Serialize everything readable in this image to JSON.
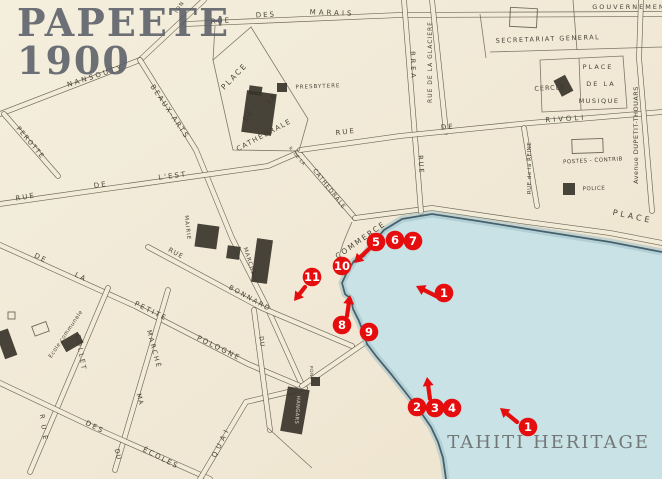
{
  "header": {
    "title_line1": "PAPEETE",
    "title_line2": "1900"
  },
  "watermark": "TAHITI HERITAGE",
  "colors": {
    "paper": "#f2ebd8",
    "water": "#c9e2e6",
    "ink": "#57503f",
    "label_ink": "#3b352b",
    "marker_red": "#e50d0d",
    "title_grey": "#5a5f68",
    "watermark_grey": "#6e7272"
  },
  "map": {
    "labels": [
      {
        "t": "RUE",
        "x": 221,
        "y": 23,
        "r": -4,
        "s": 7,
        "sp": 2
      },
      {
        "t": "DES",
        "x": 266,
        "y": 17,
        "r": -3,
        "s": 7,
        "sp": 2
      },
      {
        "t": "MARAIS",
        "x": 332,
        "y": 15,
        "r": 2,
        "s": 7,
        "sp": 3
      },
      {
        "t": "ION",
        "x": 181,
        "y": 8,
        "r": -58,
        "s": 5.5,
        "sp": 1
      },
      {
        "t": "GOUVERNEMENT",
        "x": 632,
        "y": 9,
        "r": 0,
        "s": 6.5,
        "sp": 2
      },
      {
        "t": "SECRETARIAT GENERAL",
        "x": 548,
        "y": 41,
        "r": -2,
        "s": 6.5,
        "sp": 1.5
      },
      {
        "t": "RUE DE LA GLACIERE",
        "x": 432,
        "y": 62,
        "r": -90,
        "s": 6,
        "sp": 1
      },
      {
        "t": "PLACE",
        "x": 598,
        "y": 69,
        "r": 0,
        "s": 6.5,
        "sp": 2
      },
      {
        "t": "DE LA",
        "x": 601,
        "y": 86,
        "r": 0,
        "s": 6.5,
        "sp": 2
      },
      {
        "t": "MUSIQUE",
        "x": 599,
        "y": 103,
        "r": 0,
        "s": 6.5,
        "sp": 1.5
      },
      {
        "t": "CERCLE",
        "x": 550,
        "y": 90,
        "r": -3,
        "s": 6.5,
        "sp": 1
      },
      {
        "t": "RUE",
        "x": 346,
        "y": 134,
        "r": -7,
        "s": 7,
        "sp": 2
      },
      {
        "t": "DE",
        "x": 448,
        "y": 129,
        "r": -5,
        "s": 7,
        "sp": 2
      },
      {
        "t": "RIVOLI",
        "x": 566,
        "y": 121,
        "r": -4,
        "s": 7,
        "sp": 3
      },
      {
        "t": "RUE de la REINE",
        "x": 531,
        "y": 168,
        "r": -90,
        "s": 5.5,
        "sp": 0.5
      },
      {
        "t": "POSTES - CONTRIB",
        "x": 593,
        "y": 162,
        "r": -3,
        "s": 5.5,
        "sp": 0.5
      },
      {
        "t": "POLICE",
        "x": 594,
        "y": 190,
        "r": -2,
        "s": 5.5,
        "sp": 0.5
      },
      {
        "t": "Avenue DUPETIT-THOUARS",
        "x": 638,
        "y": 135,
        "r": -90,
        "s": 6.5,
        "sp": 0.5
      },
      {
        "t": "PLACE",
        "x": 632,
        "y": 219,
        "r": 12,
        "s": 8,
        "sp": 3
      },
      {
        "t": "PLACE",
        "x": 236,
        "y": 78,
        "r": -46,
        "s": 7.5,
        "sp": 2
      },
      {
        "t": "DE",
        "x": 250,
        "y": 117,
        "r": -50,
        "s": 7,
        "sp": 1
      },
      {
        "t": "LA",
        "x": 273,
        "y": 100,
        "r": -50,
        "s": 7,
        "sp": 1
      },
      {
        "t": "CATHEDRALE",
        "x": 265,
        "y": 137,
        "r": -28,
        "s": 7,
        "sp": 1.5
      },
      {
        "t": "R. DE LA",
        "x": 296,
        "y": 157,
        "r": 50,
        "s": 4.5,
        "sp": 0.5
      },
      {
        "t": "CATHEDRALE",
        "x": 328,
        "y": 190,
        "r": 52,
        "s": 6,
        "sp": 1
      },
      {
        "t": "PRESBYTERE",
        "x": 318,
        "y": 88,
        "r": -2,
        "s": 5.5,
        "sp": 1
      },
      {
        "t": "COMMERCE",
        "x": 362,
        "y": 242,
        "r": -35,
        "s": 7.5,
        "sp": 2
      },
      {
        "t": "BREA",
        "x": 411,
        "y": 66,
        "r": 88,
        "s": 6.5,
        "sp": 3
      },
      {
        "t": "RUE",
        "x": 419,
        "y": 165,
        "r": 86,
        "s": 6.5,
        "sp": 2
      },
      {
        "t": "NANSOUTY",
        "x": 96,
        "y": 78,
        "r": -18,
        "s": 7,
        "sp": 2.5
      },
      {
        "t": "BEAUX-ARTS",
        "x": 168,
        "y": 113,
        "r": 56,
        "s": 7,
        "sp": 2
      },
      {
        "t": "PEROTTE",
        "x": 29,
        "y": 144,
        "r": 50,
        "s": 6.5,
        "sp": 1.5
      },
      {
        "t": "RUE",
        "x": 26,
        "y": 199,
        "r": -10,
        "s": 7,
        "sp": 2
      },
      {
        "t": "DE",
        "x": 101,
        "y": 187,
        "r": -8,
        "s": 7,
        "sp": 2
      },
      {
        "t": "L'EST",
        "x": 173,
        "y": 178,
        "r": -7,
        "s": 7,
        "sp": 2
      },
      {
        "t": "MAIRIE",
        "x": 186,
        "y": 228,
        "r": 84,
        "s": 5.5,
        "sp": 1
      },
      {
        "t": "RUE",
        "x": 175,
        "y": 255,
        "r": 28,
        "s": 6.5,
        "sp": 1
      },
      {
        "t": "BONNARD",
        "x": 249,
        "y": 300,
        "r": 29,
        "s": 6.5,
        "sp": 2
      },
      {
        "t": "MARCHÉ",
        "x": 248,
        "y": 262,
        "r": 72,
        "s": 5.5,
        "sp": 1
      },
      {
        "t": "DU",
        "x": 260,
        "y": 342,
        "r": 82,
        "s": 6,
        "sp": 1
      },
      {
        "t": "DE",
        "x": 40,
        "y": 260,
        "r": 26,
        "s": 7,
        "sp": 2
      },
      {
        "t": "LA",
        "x": 80,
        "y": 279,
        "r": 26,
        "s": 7,
        "sp": 2
      },
      {
        "t": "PETITE",
        "x": 150,
        "y": 313,
        "r": 26,
        "s": 7,
        "sp": 2
      },
      {
        "t": "POLOGNE",
        "x": 218,
        "y": 350,
        "r": 26,
        "s": 7,
        "sp": 2
      },
      {
        "t": "Ecole communale",
        "x": 67,
        "y": 335,
        "r": -56,
        "s": 5.5,
        "sp": 0.5
      },
      {
        "t": "COLLET",
        "x": 79,
        "y": 353,
        "r": 80,
        "s": 6.5,
        "sp": 2
      },
      {
        "t": "RUE",
        "x": 42,
        "y": 430,
        "r": 82,
        "s": 6.5,
        "sp": 6
      },
      {
        "t": "MARCHÉ",
        "x": 152,
        "y": 350,
        "r": 75,
        "s": 6.5,
        "sp": 2
      },
      {
        "t": "MA",
        "x": 138,
        "y": 400,
        "r": 75,
        "s": 6.5,
        "sp": 1
      },
      {
        "t": "DU",
        "x": 116,
        "y": 455,
        "r": 75,
        "s": 6.5,
        "sp": 1
      },
      {
        "t": "DES",
        "x": 94,
        "y": 429,
        "r": 27,
        "s": 7,
        "sp": 2
      },
      {
        "t": "ÉCOLES",
        "x": 160,
        "y": 460,
        "r": 27,
        "s": 7,
        "sp": 2
      },
      {
        "t": "QUAI",
        "x": 223,
        "y": 443,
        "r": -64,
        "s": 7,
        "sp": 4
      },
      {
        "t": "HANGARS",
        "x": 296,
        "y": 410,
        "r": 94,
        "s": 5,
        "sp": 0.5,
        "c": "light"
      },
      {
        "t": "PONT",
        "x": 310,
        "y": 373,
        "r": 88,
        "s": 4.5,
        "sp": 0.5
      }
    ],
    "markers": [
      {
        "n": "1",
        "x": 444,
        "y": 293
      },
      {
        "n": "1",
        "x": 528,
        "y": 427
      },
      {
        "n": "2",
        "x": 417,
        "y": 407
      },
      {
        "n": "3",
        "x": 435,
        "y": 408
      },
      {
        "n": "4",
        "x": 452,
        "y": 408
      },
      {
        "n": "5",
        "x": 376,
        "y": 242
      },
      {
        "n": "6",
        "x": 395,
        "y": 240
      },
      {
        "n": "7",
        "x": 413,
        "y": 241
      },
      {
        "n": "8",
        "x": 342,
        "y": 325
      },
      {
        "n": "9",
        "x": 369,
        "y": 332
      },
      {
        "n": "10",
        "x": 342,
        "y": 266
      },
      {
        "n": "11",
        "x": 312,
        "y": 277
      }
    ],
    "arrows": [
      {
        "x1": 438,
        "y1": 297,
        "x2": 416,
        "y2": 286
      },
      {
        "x1": 517,
        "y1": 422,
        "x2": 500,
        "y2": 408
      },
      {
        "x1": 430,
        "y1": 399,
        "x2": 427,
        "y2": 377
      },
      {
        "x1": 369,
        "y1": 249,
        "x2": 354,
        "y2": 263
      },
      {
        "x1": 347,
        "y1": 316,
        "x2": 350,
        "y2": 295
      },
      {
        "x1": 305,
        "y1": 287,
        "x2": 294,
        "y2": 301
      }
    ]
  }
}
